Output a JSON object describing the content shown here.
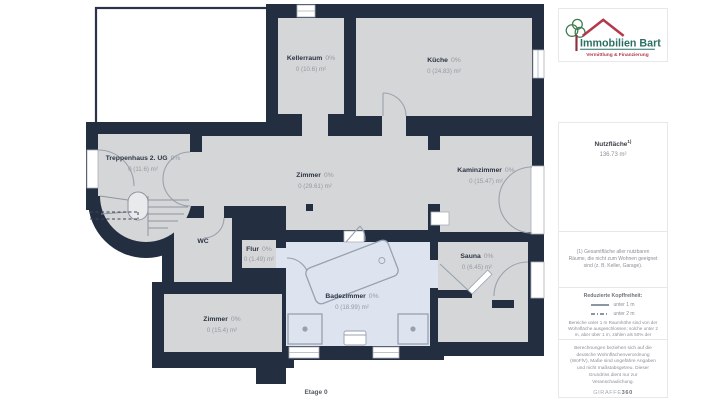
{
  "floorplan": {
    "floor_label": "Etage 0",
    "rooms": [
      {
        "name": "Kellerraum",
        "percent": "0%",
        "area": "0 (10.6) m²"
      },
      {
        "name": "Küche",
        "percent": "0%",
        "area": "0 (24.83) m²"
      },
      {
        "name": "Treppenhaus 2. UG",
        "percent": "0%",
        "area": "0 (11.6) m²"
      },
      {
        "name": "Zimmer",
        "percent": "0%",
        "area": "0 (29.61) m²"
      },
      {
        "name": "Kaminzimmer",
        "percent": "0%",
        "area": "0 (15.47) m²"
      },
      {
        "name": "WC"
      },
      {
        "name": "Flur",
        "percent": "0%",
        "area": "0 (1.49) m²"
      },
      {
        "name": "Zimmer",
        "percent": "0%",
        "area": "0 (15.4) m²"
      },
      {
        "name": "Badezimmer",
        "percent": "0%",
        "area": "0 (18.99) m²"
      },
      {
        "name": "Sauna",
        "percent": "0%",
        "area": "0 (6.45) m²"
      }
    ],
    "colors": {
      "wall": "#232f40",
      "room_fill": "#d5d6d7",
      "bath_fill": "#dee4ef",
      "label_dark": "#2c3545",
      "label_gray": "#949aa3"
    }
  },
  "sidebar": {
    "logo": {
      "title": "Immobilien Bart",
      "subtitle": "Vermittlung & Finanzierung",
      "colors": {
        "teal": "#2a6f63",
        "red": "#b5374a",
        "green": "#3f7d4e"
      }
    },
    "area_summary": {
      "label": "Nutzfläche",
      "sup": "1)",
      "value": "136.73 m²"
    },
    "footnote": "(1) Gesamtfläche aller nutzbaren Räume, die nicht zum Wohnen geeignet sind (z. B. Keller, Garage).",
    "legend": {
      "title": "Reduzierte Kopffreiheit:",
      "items": [
        {
          "style": "solid",
          "label": "unter 1 m"
        },
        {
          "style": "dashdot",
          "label": "unter 2 m"
        }
      ],
      "note": "Bereiche unter 1 m Raumhöhe sind von der Wohnfläche ausgeschlossen; solche unter 2 m, aber über 1 m, zählen als 50% der Wohnfläche."
    },
    "disclaimer": "Berechnungen beziehen sich auf die deutsche Wohnflächenverordnung (WoFlV), Maße sind ungefähre Angaben und nicht maßstabsgetreu. Dieser Grundriss dient nur zur Veranschaulichung.",
    "brand_prefix": "GIRAFFE",
    "brand_suffix": "360"
  }
}
